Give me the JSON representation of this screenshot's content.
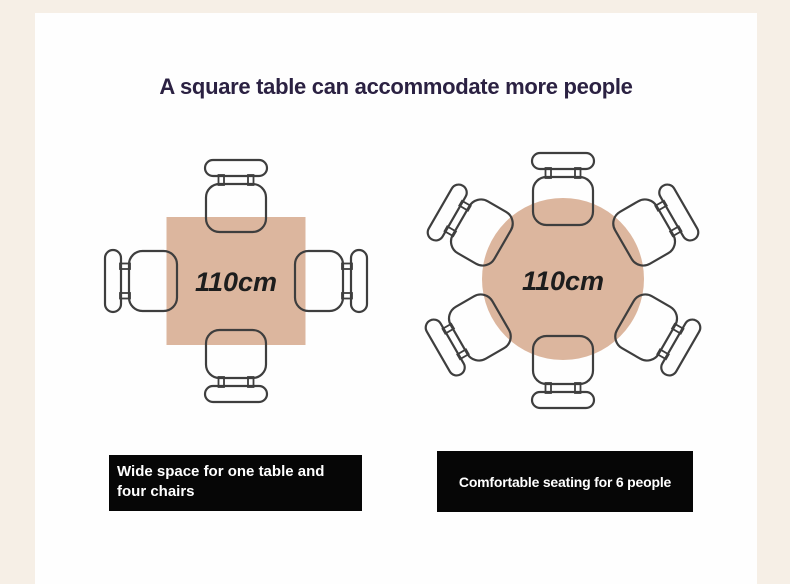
{
  "title": "A square table can accommodate more people",
  "diagrams": {
    "square": {
      "table_shape": "square",
      "measurement": "110cm",
      "seats": 4
    },
    "round": {
      "table_shape": "round",
      "measurement": "110cm",
      "seats": 6
    }
  },
  "captions": {
    "left": {
      "text": "Wide space for one table and four chairs",
      "lines": [
        "Wide space for one table and",
        "four chairs"
      ]
    },
    "right": {
      "text": "Comfortable seating for 6 people",
      "lines": [
        "Comfortable seating for 6 people"
      ]
    }
  },
  "colors": {
    "frame-cream": "#f6efe6",
    "panel-white": "#fefefe",
    "title-ink": "#2b2142",
    "table-tan": "#dcb69e",
    "line-ink": "#3e3e3e",
    "measure-ink": "#1d1d1d",
    "caption-bg": "#060606",
    "caption-text": "#ffffff"
  }
}
